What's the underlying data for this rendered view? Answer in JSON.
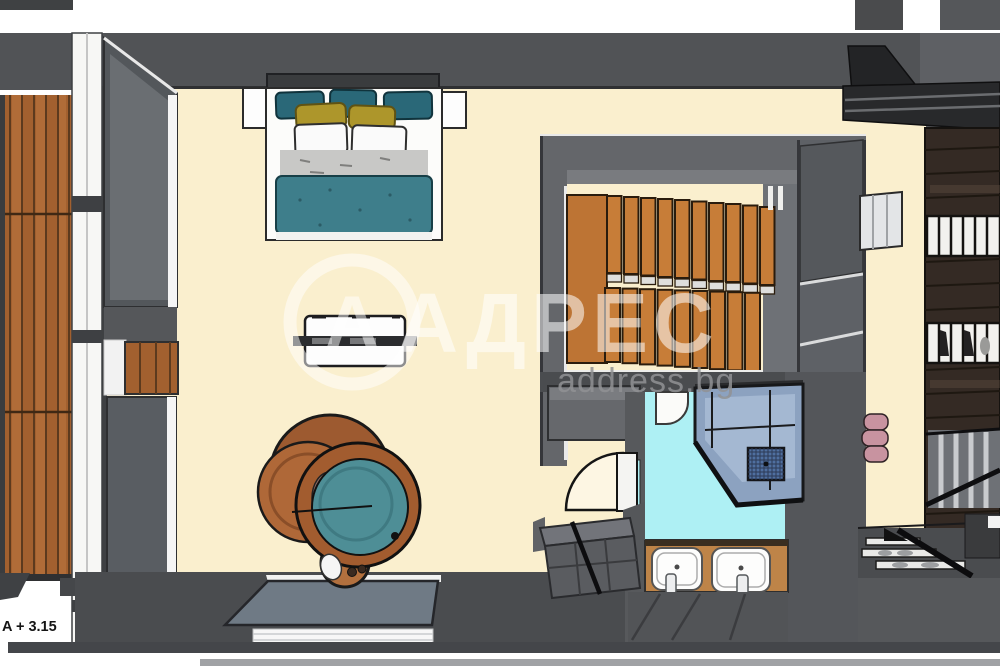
{
  "labels": {
    "elevation_mark": "A + 3.15",
    "watermark_title": "АДРЕС",
    "watermark_domain": "address.bg"
  },
  "palette": {
    "floor_cream": "#FAEFCE",
    "wall_dark": "#4A4C4F",
    "wall_medium": "#64666A",
    "wall_light": "#6E7176",
    "deck_wood": "#A2602F",
    "stair_wood": "#C77D38",
    "stair_landing": "#BD7434",
    "wardrobe_wood": "#342A24",
    "bed_duvet_teal": "#3E7E8B",
    "pillow_teal": "#2A6878",
    "pillow_yellow": "#AD962B",
    "sheet_gray": "#C8C8C6",
    "tub_wood": "#A25C2F",
    "tub_water_teal": "#4E8E96",
    "bath_floor_cyan": "#AEF0F4",
    "shower_glass_blue": "#8CA2C0",
    "vanity_wood": "#BE8448",
    "pouf_pink": "#C893A0",
    "window_glass_gray": "#6A6E72",
    "bottom_band_gray": "#A0A2A5",
    "outline_black": "#1A1A1A",
    "watermark_white": "#FFFFFF",
    "watermark_gray": "#909294"
  },
  "scene_items": [
    "balcony-deck",
    "window-wall",
    "double-bed",
    "nightstands",
    "bench",
    "hot-tub",
    "south-window",
    "staircase",
    "stair-enclosure",
    "door-swing",
    "bathroom",
    "shower",
    "toilet",
    "double-sink-vanity",
    "wardrobe-shelving",
    "poufs",
    "ac-panel",
    "corner-shelf"
  ]
}
